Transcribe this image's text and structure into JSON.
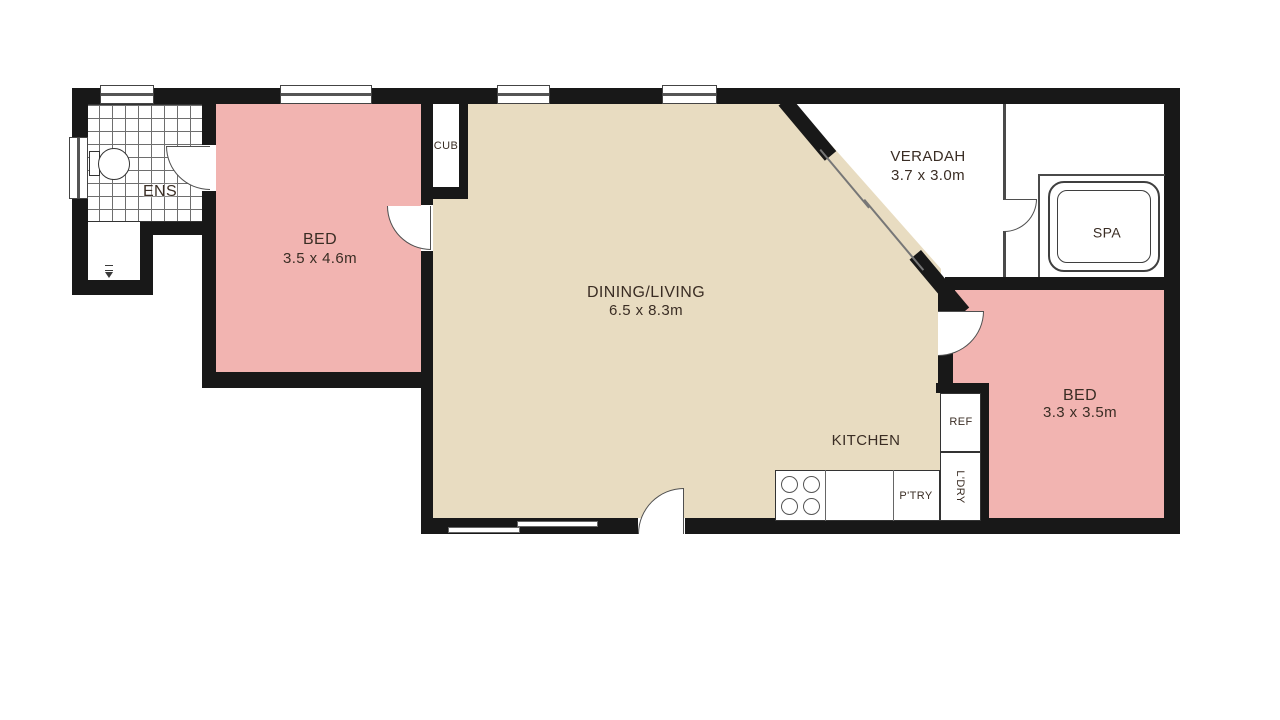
{
  "title": "Floor plan",
  "colors": {
    "wall": "#181818",
    "bedroom_fill": "#f2b4b1",
    "living_fill": "#e8dcc1",
    "floor_white": "#ffffff",
    "label_text": "#3a2d24"
  },
  "rooms": {
    "ens": {
      "name": "ENS"
    },
    "bed1": {
      "name": "BED",
      "dims": "3.5 x 4.6m"
    },
    "cub": {
      "name": "CUB"
    },
    "dining": {
      "name": "DINING/LIVING",
      "dims": "6.5 x 8.3m"
    },
    "veradah": {
      "name": "VERADAH",
      "dims": "3.7 x 3.0m"
    },
    "spa": {
      "name": "SPA"
    },
    "bed2": {
      "name": "BED",
      "dims": "3.3 x 3.5m"
    },
    "kitchen": {
      "name": "KITCHEN"
    },
    "ref": {
      "name": "REF"
    },
    "ldry": {
      "name": "L'DRY"
    },
    "ptry": {
      "name": "P'TRY"
    }
  }
}
